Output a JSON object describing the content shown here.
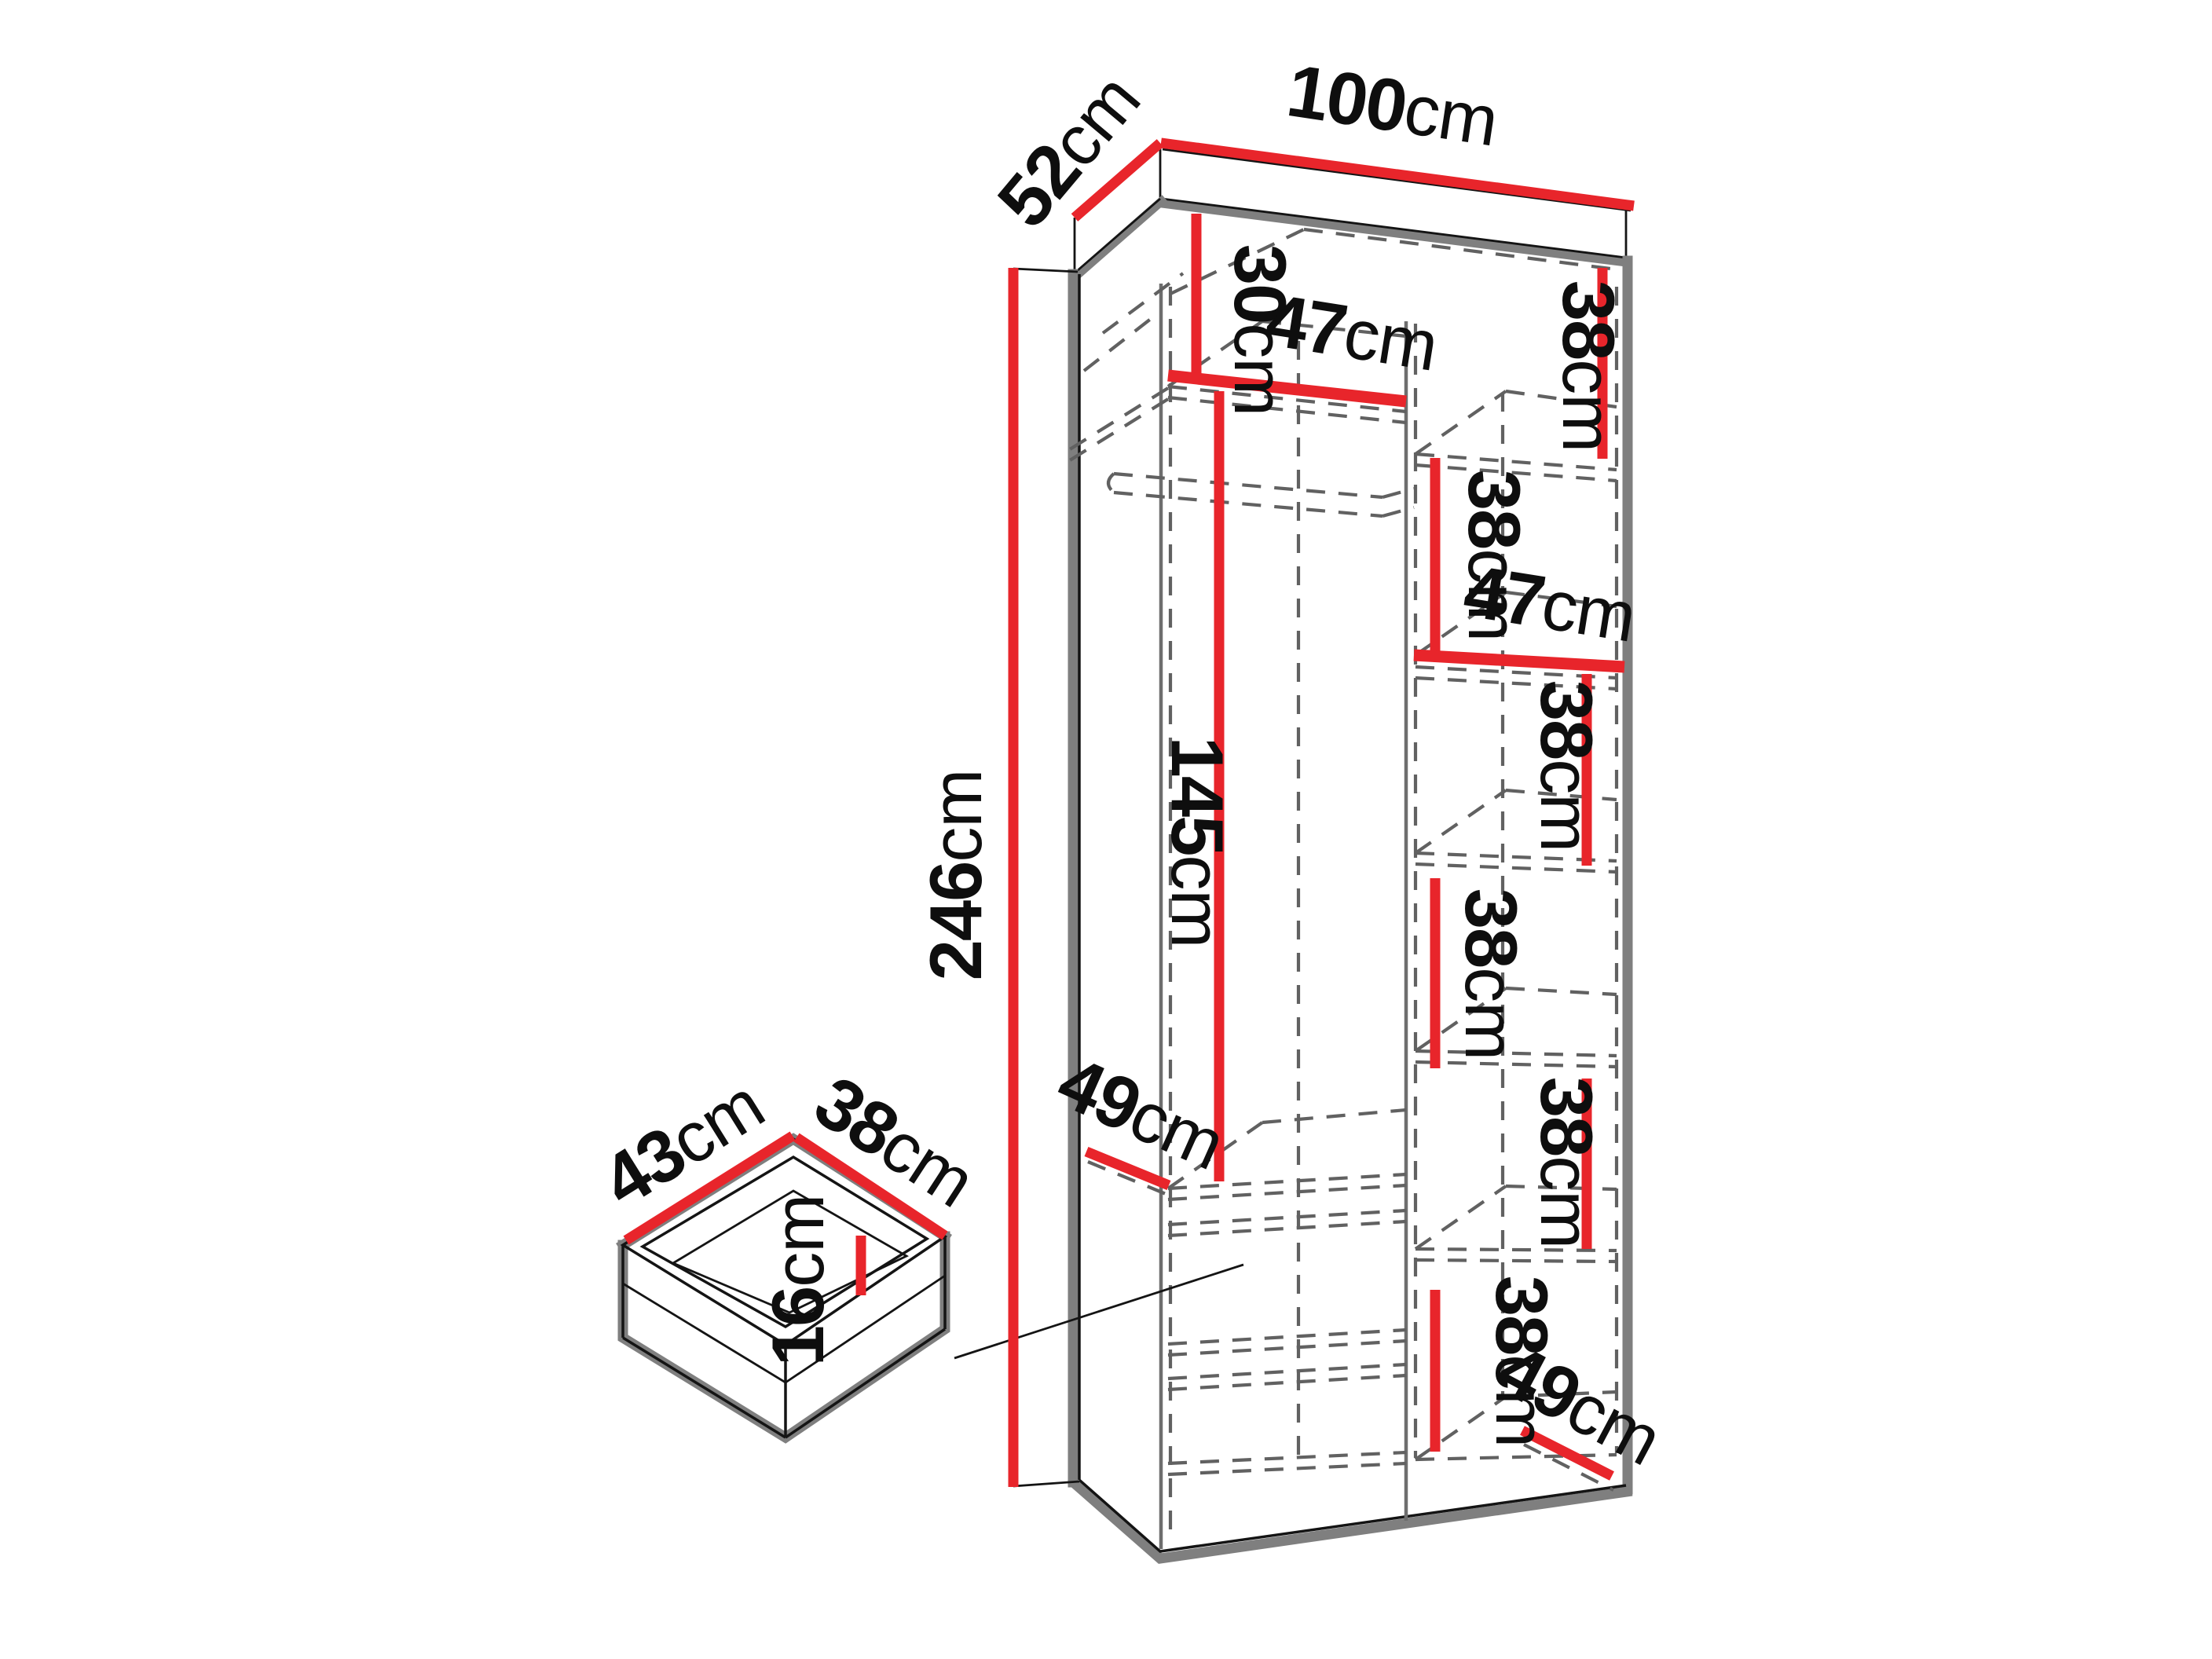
{
  "diagram": {
    "kind": "wardrobe-dimension-drawing",
    "unit": "cm",
    "colors": {
      "dimension_line_red": "#e8252b",
      "panel_shadow_gray": "#7f7f7f",
      "hidden_edge_dash_gray": "#616161",
      "label_black": "#0e0e0e",
      "background": "#ffffff"
    },
    "wardrobe": {
      "overall_width": {
        "value": "100",
        "unit": "cm"
      },
      "overall_depth": {
        "value": "52",
        "unit": "cm"
      },
      "overall_height": {
        "value": "246",
        "unit": "cm"
      },
      "top_compartment_height": {
        "value": "30",
        "unit": "cm"
      },
      "left_bay_width": {
        "value": "47",
        "unit": "cm"
      },
      "hanging_space_height": {
        "value": "145",
        "unit": "cm"
      },
      "left_bay_depth": {
        "value": "49",
        "unit": "cm"
      },
      "right_bay_width": {
        "value": "47",
        "unit": "cm"
      },
      "right_bay_depth": {
        "value": "49",
        "unit": "cm"
      },
      "right_bay_gap_1": {
        "value": "38",
        "unit": "cm"
      },
      "right_bay_gap_2": {
        "value": "38",
        "unit": "cm"
      },
      "right_bay_gap_3": {
        "value": "38",
        "unit": "cm"
      },
      "right_bay_gap_4": {
        "value": "38",
        "unit": "cm"
      },
      "right_bay_gap_5": {
        "value": "38",
        "unit": "cm"
      },
      "right_bay_gap_6": {
        "value": "38",
        "unit": "cm"
      }
    },
    "drawer": {
      "width": {
        "value": "43",
        "unit": "cm"
      },
      "depth": {
        "value": "38",
        "unit": "cm"
      },
      "height": {
        "value": "16",
        "unit": "cm"
      }
    }
  }
}
